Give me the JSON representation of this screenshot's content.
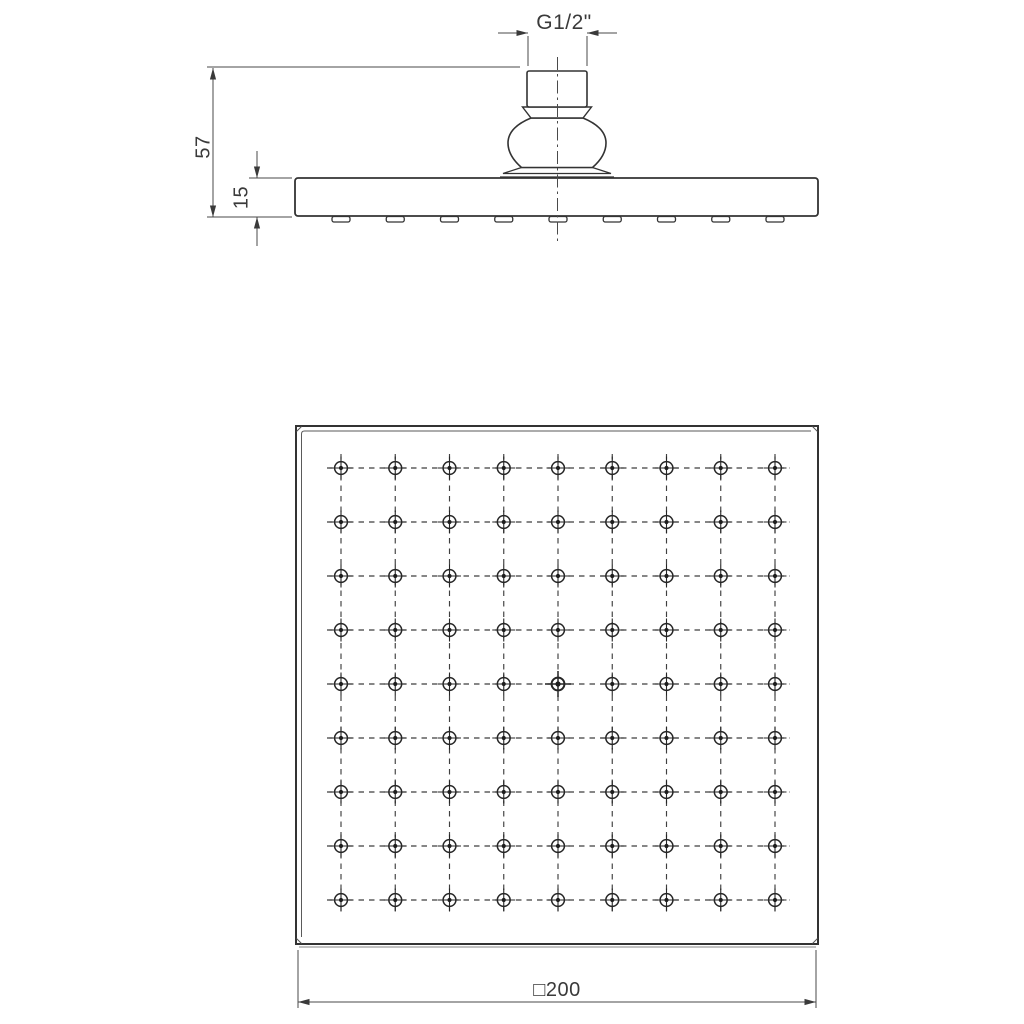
{
  "drawing": {
    "type": "technical-dimension-drawing",
    "subject": "square-overhead-shower-head",
    "labels": {
      "thread_size": "G1/2\"",
      "overall_height": "57",
      "head_thickness": "15",
      "face_width": "□200"
    },
    "nozzle_grid": {
      "rows": 9,
      "cols": 9
    },
    "colors": {
      "line": "#333333",
      "dimension": "#4a4a4a",
      "background": "#ffffff"
    }
  }
}
